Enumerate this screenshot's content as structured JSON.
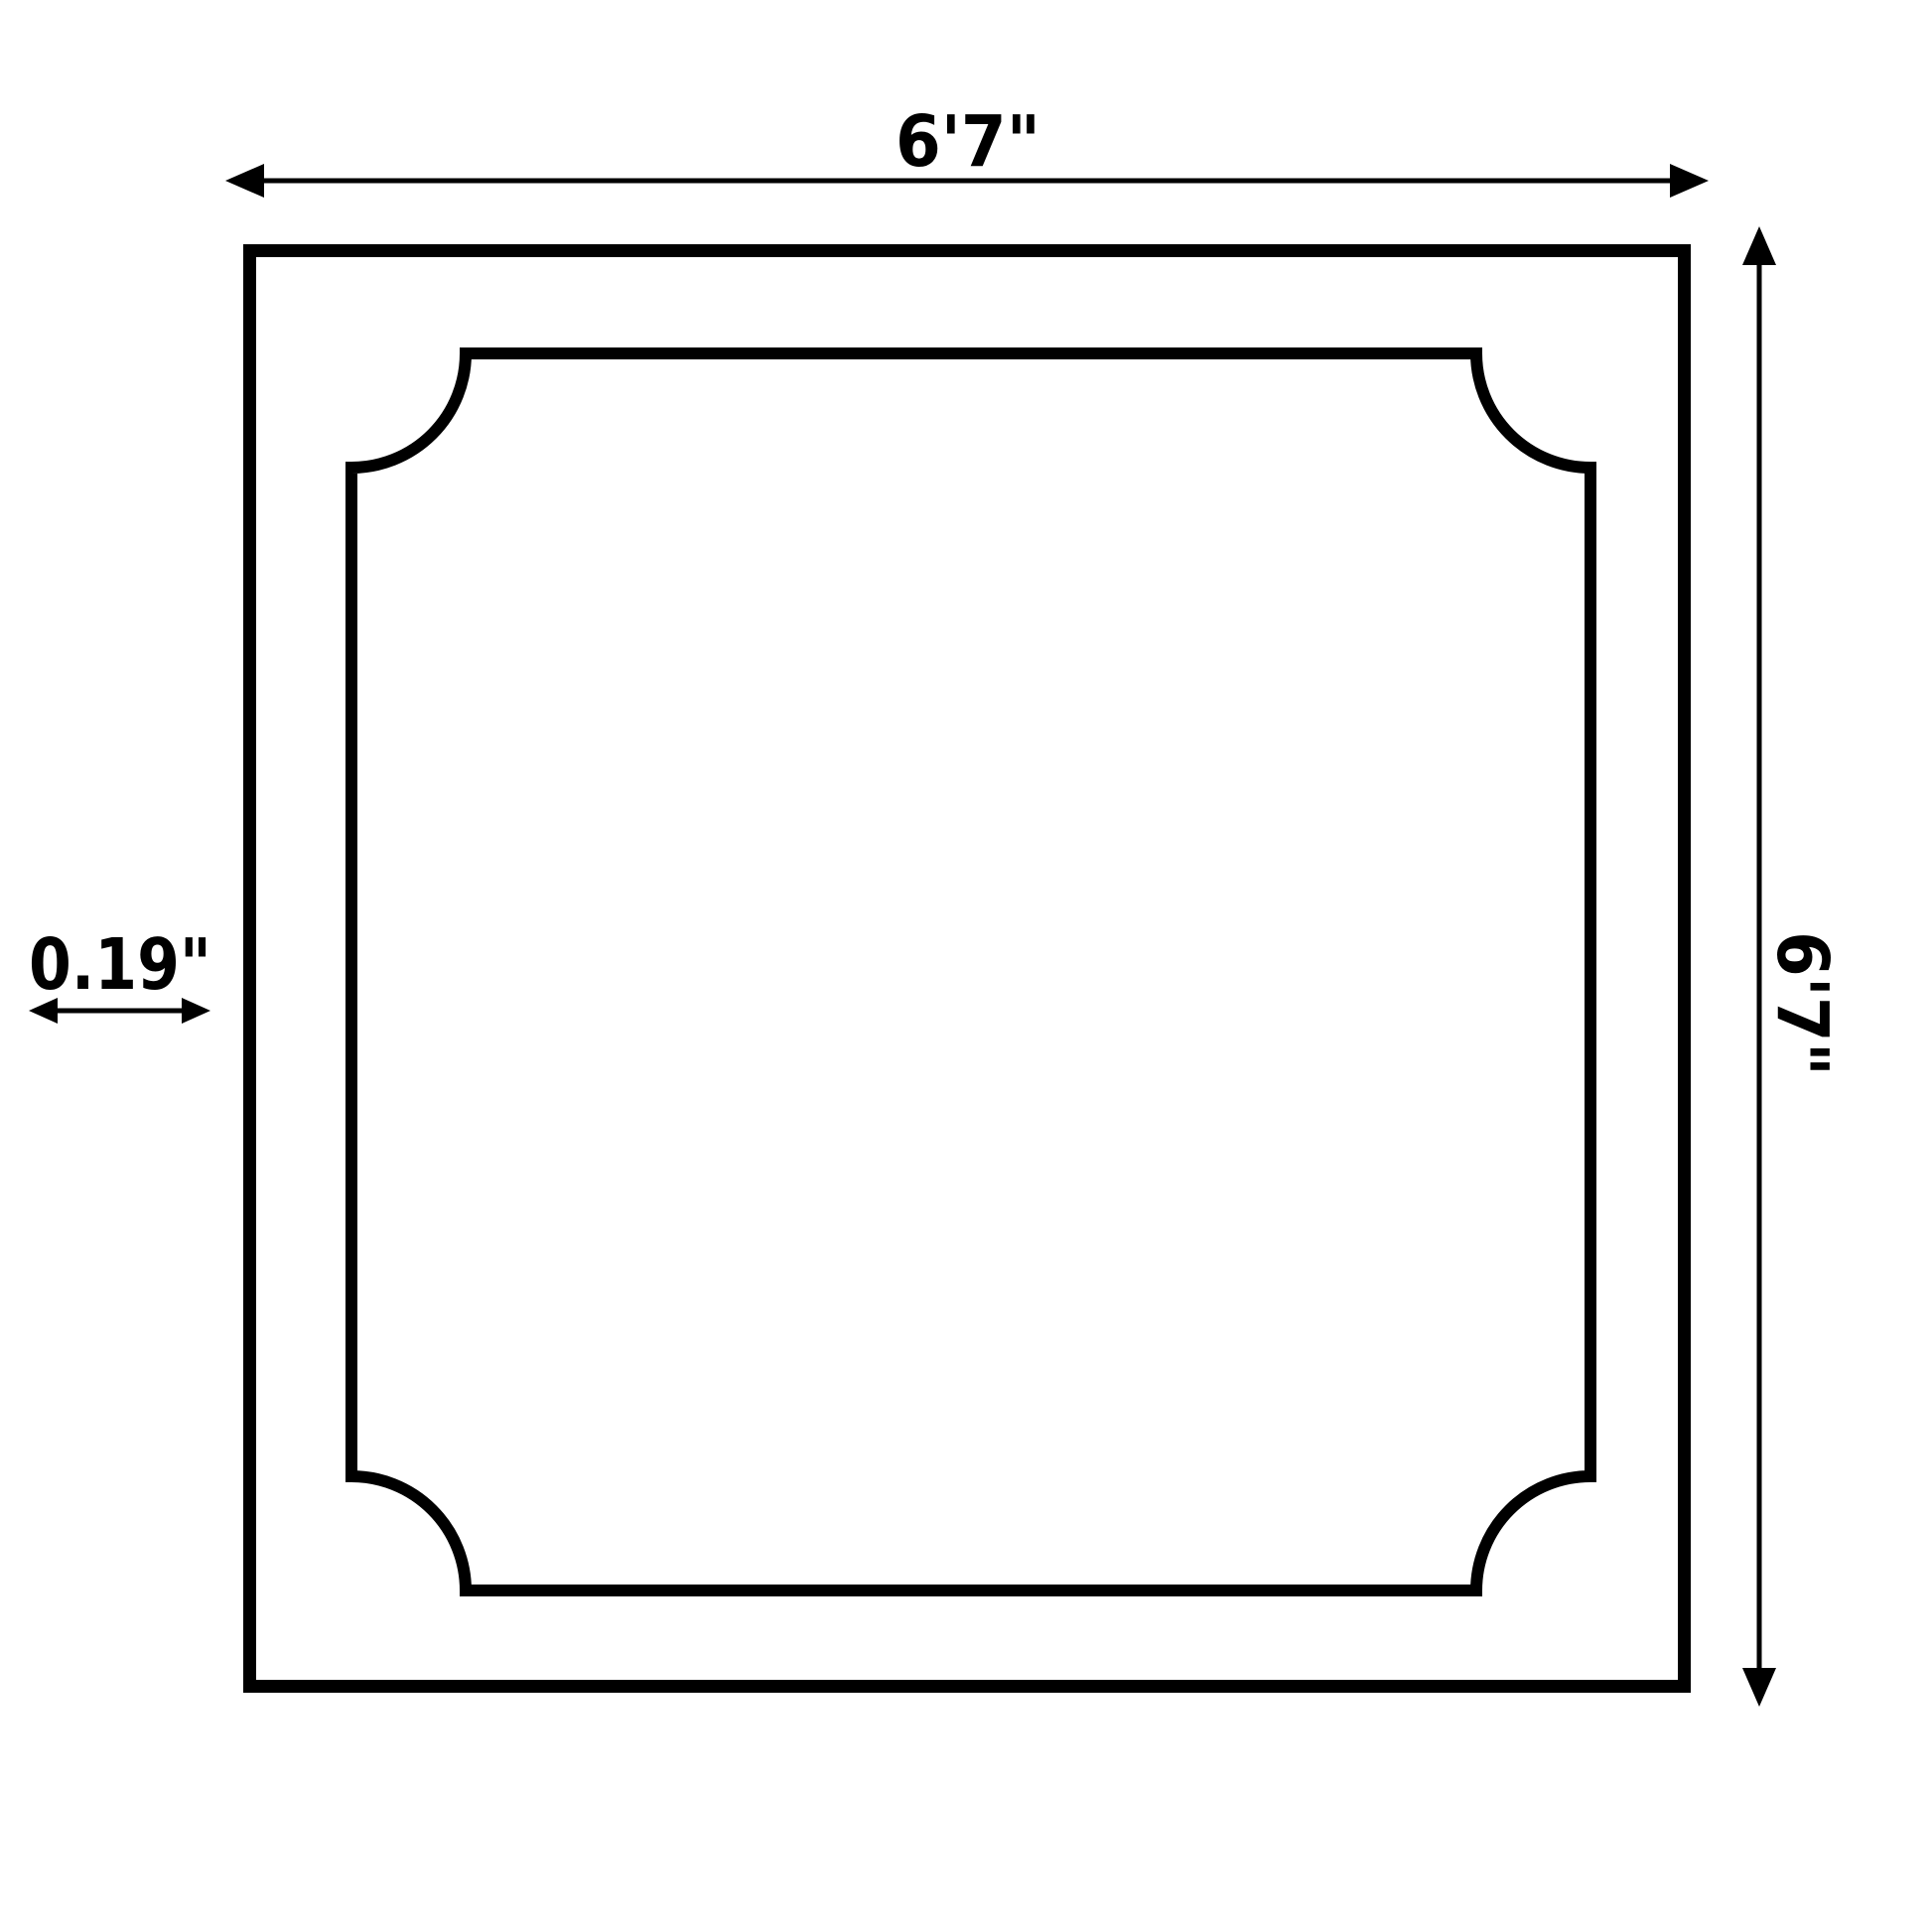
{
  "colors": {
    "background": "#ffffff",
    "ink": "#000000"
  },
  "dimensions": {
    "width": {
      "label": "6'7\"",
      "position": "top"
    },
    "height": {
      "label": "6'7\"",
      "position": "right"
    },
    "thickness": {
      "label": "0.19\"",
      "position": "left"
    }
  }
}
